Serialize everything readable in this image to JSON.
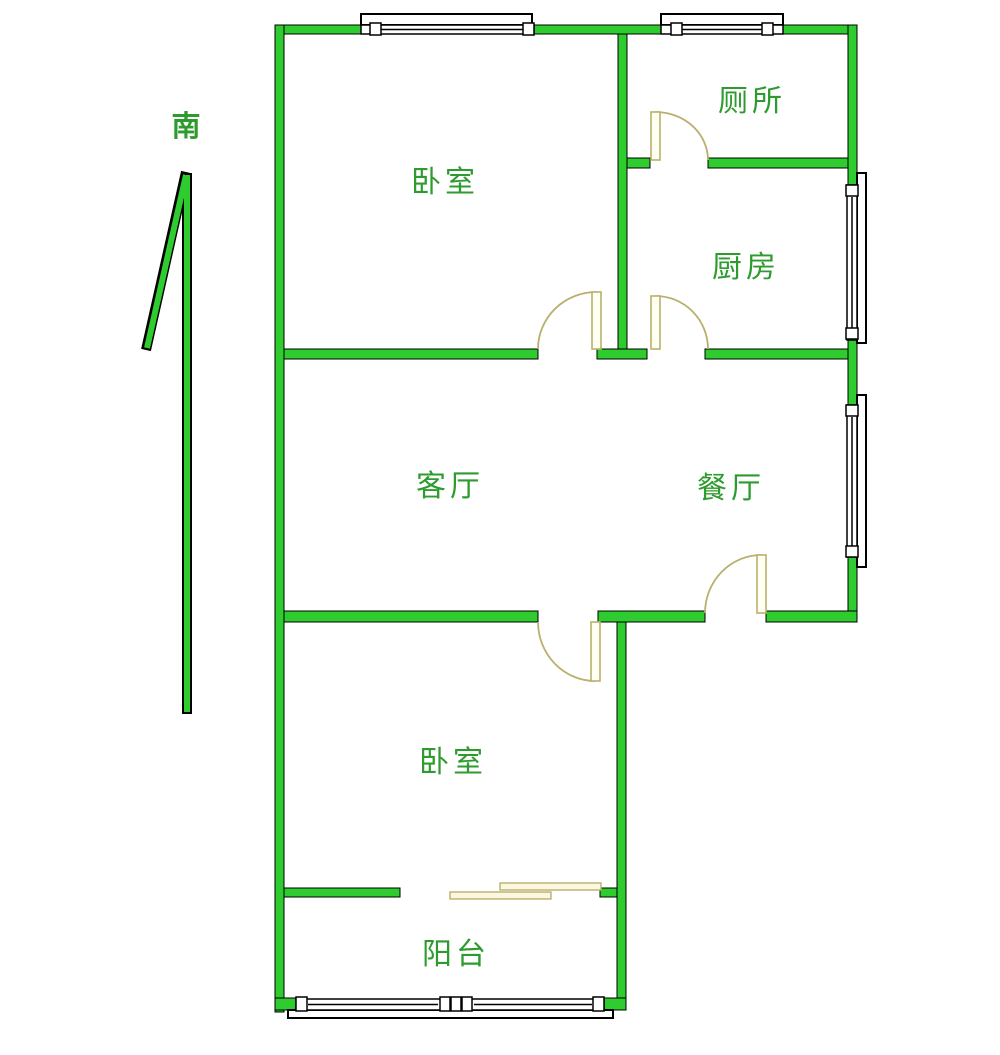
{
  "compass": {
    "label": "南"
  },
  "rooms": [
    {
      "id": "bedroom-top",
      "label": "卧室"
    },
    {
      "id": "toilet",
      "label": "厕所"
    },
    {
      "id": "kitchen",
      "label": "厨房"
    },
    {
      "id": "living-room",
      "label": "客厅"
    },
    {
      "id": "dining-room",
      "label": "餐厅"
    },
    {
      "id": "bedroom-bottom",
      "label": "卧室"
    },
    {
      "id": "balcony",
      "label": "阳台"
    }
  ],
  "colors": {
    "wall": "#2ECC2E",
    "wall_outline": "#000000",
    "label": "#2E9B2E",
    "door": "#B9B06E",
    "background": "#FFFFFF"
  }
}
